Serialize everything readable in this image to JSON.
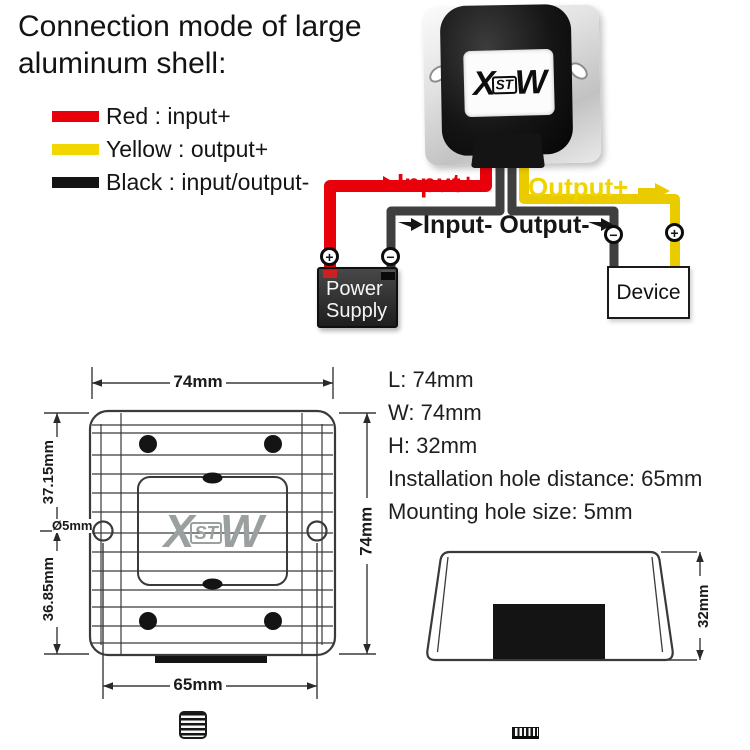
{
  "title": {
    "line1": "Connection mode of large",
    "line2": "aluminum shell:"
  },
  "legend": {
    "items": [
      {
        "name": "red",
        "color": "#e8000a",
        "label": "Red : input+"
      },
      {
        "name": "yellow",
        "color": "#f2d600",
        "label": "Yellow : output+"
      },
      {
        "name": "black",
        "color": "#141414",
        "label": "Black : input/output-"
      }
    ]
  },
  "colors": {
    "input_positive": "#e8000a",
    "output_positive": "#e9cb00",
    "output_text": "#f0d400",
    "negative_wire": "#3f3f3f",
    "ink_black": "#161616",
    "drawing_stroke": "#3a3a3a",
    "logo_gray": "#9aa0a0"
  },
  "wiring": {
    "labels": {
      "input_plus": "Input+",
      "output_plus": "Output+",
      "input_minus_output_minus": "Input- Output-"
    },
    "power_supply": {
      "line1": "Power",
      "line2": "Supply"
    },
    "device": "Device",
    "terminals": {
      "power_supply_positive": "+",
      "power_supply_negative": "−",
      "device_negative": "−",
      "device_positive": "+"
    }
  },
  "converter": {
    "logo_x": "X",
    "logo_st": "ST",
    "logo_w": "W"
  },
  "specs": {
    "lines": [
      "L: 74mm",
      "W: 74mm",
      "H: 32mm",
      "Installation hole distance: 65mm",
      "Mounting hole size: 5mm"
    ]
  },
  "top_view": {
    "width_label": "74mm",
    "height_label": "74mm",
    "upper_section_label": "37.15mm",
    "lower_section_label": "36.85mm",
    "hole_diameter_label": "Ø5mm",
    "hole_distance_label": "65mm"
  },
  "side_view": {
    "height_label": "32mm"
  }
}
